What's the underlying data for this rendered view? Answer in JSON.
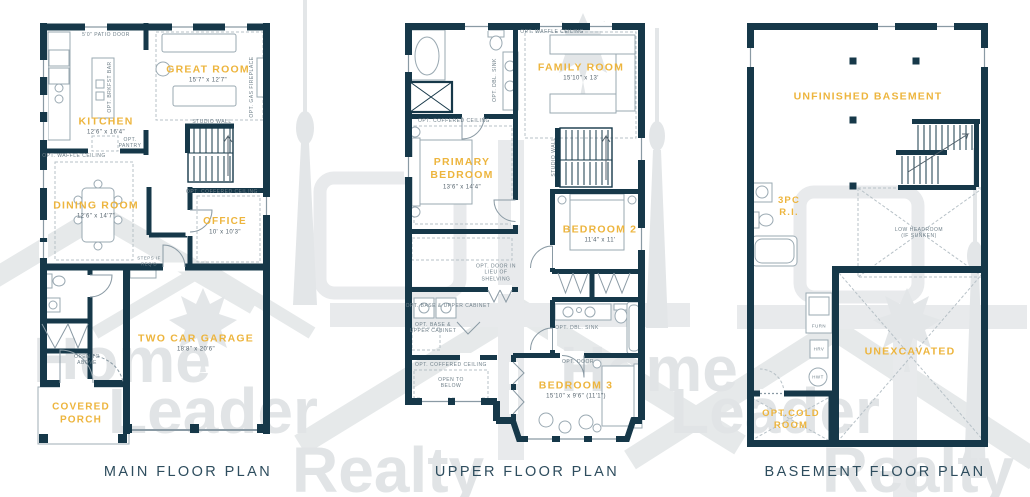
{
  "colors": {
    "wall_navy": "#163849",
    "accent_yellow": "#edb53e",
    "note_gray": "#70808a",
    "title_slate": "#2e4d5e",
    "watermark_gray": "#e3e6e8"
  },
  "watermark": {
    "brand_words": [
      "Home",
      "Leader",
      "Realty"
    ]
  },
  "plans": {
    "main": {
      "title": "MAIN FLOOR PLAN",
      "rooms": {
        "great_room": {
          "name": "GREAT ROOM",
          "dims": "15'7\" x 12'7\""
        },
        "kitchen": {
          "name": "KITCHEN",
          "dims": "12'6\" x 16'4\""
        },
        "dining_room": {
          "name": "DINING ROOM",
          "dims": "12'6\" x 14'7\""
        },
        "office": {
          "name": "OFFICE",
          "dims": "10' x 10'3\""
        },
        "garage": {
          "name": "TWO CAR GARAGE",
          "dims": "18'8\" x 20'6\""
        },
        "porch": {
          "name": "COVERED PORCH"
        }
      },
      "notes": {
        "patio_door": "5'0\" PATIO DOOR",
        "gas_fireplace": "OPT. GAS FIREPLACE",
        "brkfst_bar": "OPT. BRKFST BAR",
        "pantry": "OPT. PANTRY",
        "studio_wall": "STUDIO WALL",
        "waffle_ceiling": "OPT. WAFFLE CEILING",
        "coffered_ceiling": "OPT. COFFERED CEILING",
        "steps": "STEPS IF REQ'D",
        "open_above": "OPEN TO ABOVE"
      }
    },
    "upper": {
      "title": "UPPER FLOOR PLAN",
      "rooms": {
        "family_room": {
          "name": "FAMILY ROOM",
          "dims": "15'10\" x 13'"
        },
        "primary_bedroom": {
          "name": "PRIMARY BEDROOM",
          "dims": "13'6\" x 14'4\""
        },
        "bedroom_2": {
          "name": "BEDROOM 2",
          "dims": "11'4\" x 11'"
        },
        "bedroom_3": {
          "name": "BEDROOM 3",
          "dims": "15'10\" x 9'6\" (11'1\")"
        }
      },
      "notes": {
        "waffle_ceiling": "OPT. WAFFLE CEILING",
        "dbl_sink_ensuite": "OPT. DBL. SINK",
        "coffered_primary": "OPT. COFFERED CEILING",
        "studio_wall": "STUDIO WALL",
        "door_in_lieu": "OPT. DOOR IN LIEU OF SHELVING",
        "base_upper_cabinet_1": "OPT. BASE & UPPER CABINET",
        "base_upper_cabinet_2": "OPT. BASE & UPPER CABINET",
        "coffered_open": "OPT. COFFERED CEILING",
        "open_below": "OPEN TO BELOW",
        "dbl_sink_bath": "OPT. DBL. SINK",
        "door": "OPT. DOOR"
      }
    },
    "basement": {
      "title": "BASEMENT FLOOR PLAN",
      "rooms": {
        "unfinished": {
          "name": "UNFINISHED BASEMENT"
        },
        "unexcavated": {
          "name": "UNEXCAVATED"
        },
        "cold_room": {
          "name": "OPT.COLD ROOM"
        },
        "three_pc": {
          "name": "3PC R.I."
        }
      },
      "notes": {
        "low_headroom": "LOW HEADROOM (IF SUNKEN)",
        "furnace": "FURN",
        "hrv": "HRV",
        "hwt": "HWT"
      }
    }
  }
}
